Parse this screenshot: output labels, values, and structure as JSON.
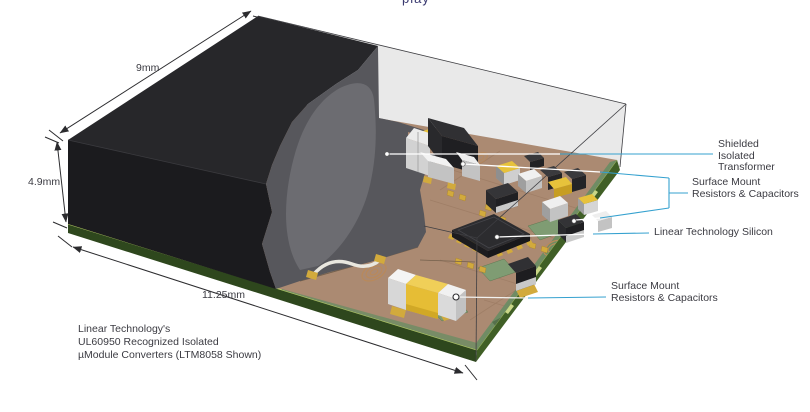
{
  "page": {
    "top_fragment": "play"
  },
  "dimensions": {
    "width_label": "9mm",
    "height_label": "4.9mm",
    "depth_label": "11.25mm"
  },
  "callouts": {
    "transformer": "Shielded\nIsolated Transformer",
    "smd_top": "Surface Mount\nResistors & Capacitors",
    "silicon": "Linear Technology Silicon",
    "smd_bottom": "Surface Mount\nResistors & Capacitors"
  },
  "caption": "Linear Technology's\nUL60950 Recognized Isolated\nµModule Converters (LTM8058 Shown)",
  "colors": {
    "callout_line_blue": "#35a1cf",
    "leader_line_white": "#ffffff",
    "label_text": "#3b3b42",
    "molding_black_top": "#27272a",
    "molding_black_front": "#1b1b1e",
    "molding_cut_gray": "#57575c",
    "molding_bulge_gray": "#6c6c71",
    "package_ghost_gray": "#e9e9e9",
    "pcb_brown": "#ab8a72",
    "soldermask_green": "#7f9c73",
    "pcb_edge_green_front": "#2e471d",
    "pcb_edge_green_right": "#405f26",
    "capacitor_yellow": "#e7c23b",
    "component_silver": "#d9d9d9",
    "gold_pad": "#d2aa3c"
  }
}
